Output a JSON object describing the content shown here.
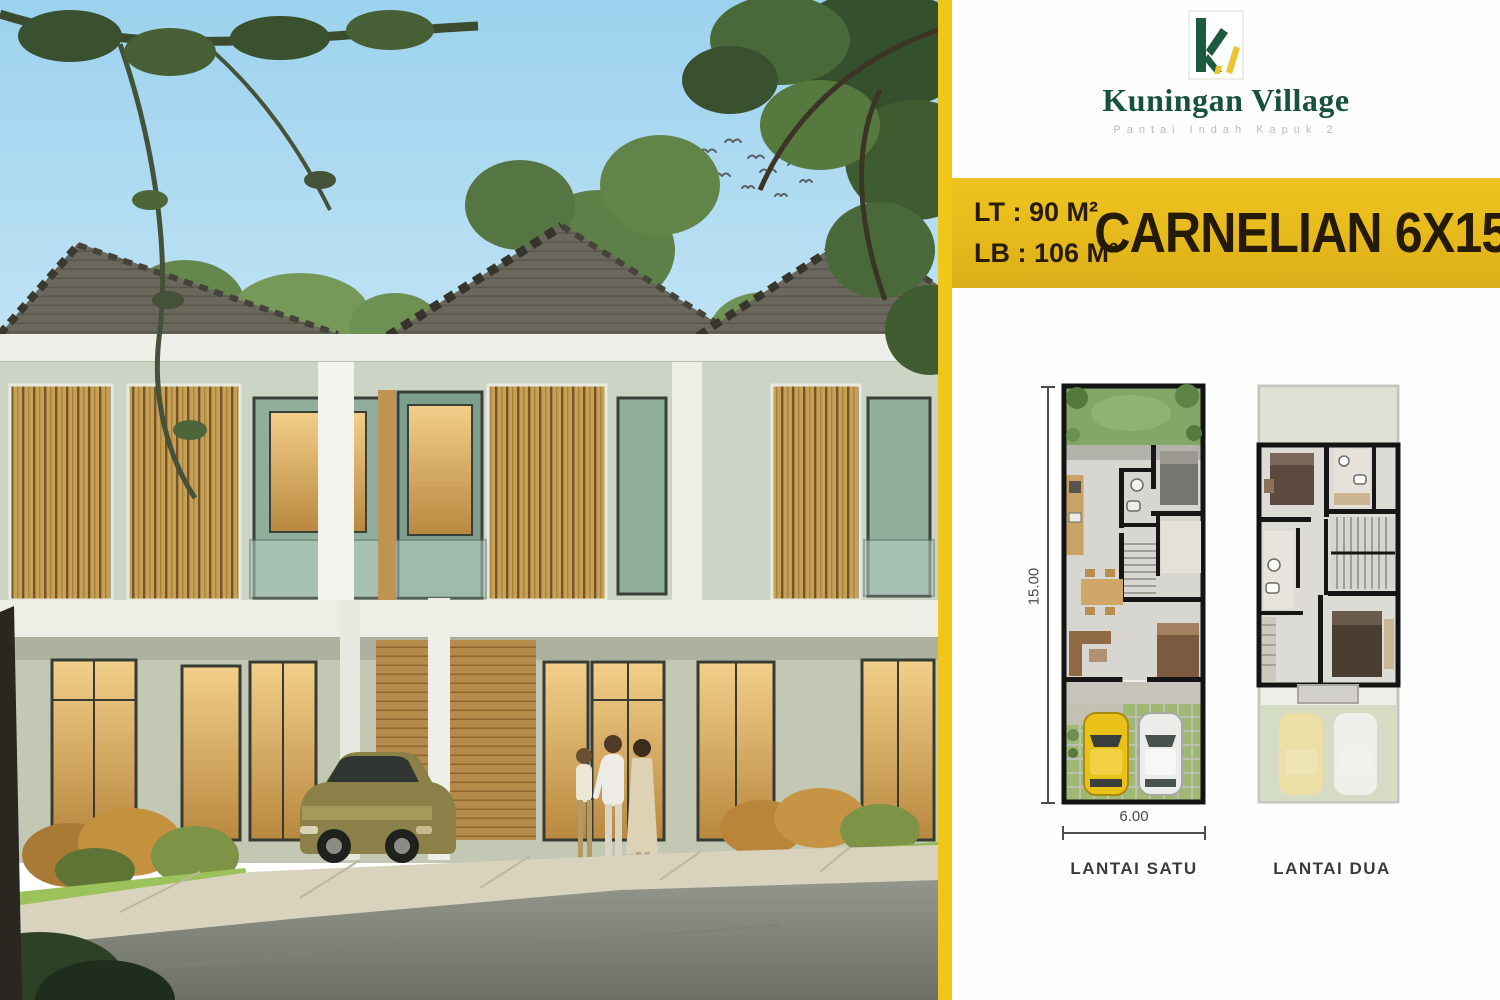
{
  "brand": {
    "name": "Kuningan Village",
    "tagline": "Pantai Indah Kapuk 2",
    "logo_green": "#1d5b3e",
    "logo_yellow": "#e9c42e"
  },
  "banner": {
    "land_area": "LT : 90 M²",
    "building_area": "LB : 106 M²",
    "title": "CARNELIAN 6X15",
    "bg_color": "#e8bd1e",
    "text_color": "#241a06"
  },
  "floorplans": {
    "depth_label": "15.00",
    "width_label": "6.00",
    "floor1_label": "LANTAI SATU",
    "floor2_label": "LANTAI DUA"
  }
}
